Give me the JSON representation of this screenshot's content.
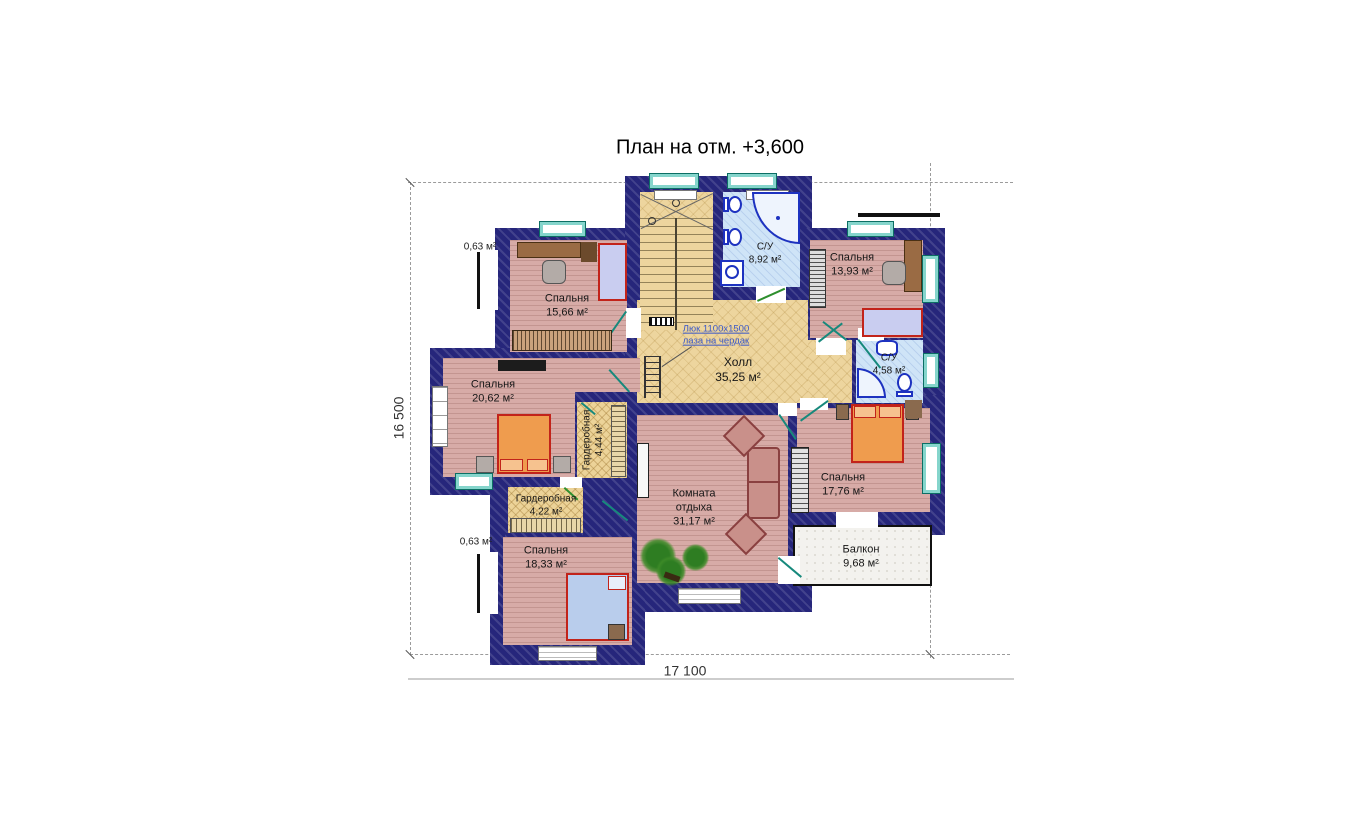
{
  "title": "План на отм. +3,600",
  "dimensions": {
    "vertical": "16 500",
    "horizontal": "17 100"
  },
  "annotations": {
    "attic_hatch_line1": "Люк 1100х1500",
    "attic_hatch_line2": "лаза на чердак",
    "niche_area_top": "0,63 м²",
    "niche_area_bottom": "0,63 м²"
  },
  "rooms": [
    {
      "id": "bedroom-top-left",
      "name": "Спальня",
      "area": "15,66 м²"
    },
    {
      "id": "bathroom-top",
      "name": "С/У",
      "area": "8,92 м²"
    },
    {
      "id": "bedroom-top-right",
      "name": "Спальня",
      "area": "13,93 м²"
    },
    {
      "id": "hall",
      "name": "Холл",
      "area": "35,25 м²"
    },
    {
      "id": "bedroom-left",
      "name": "Спальня",
      "area": "20,62 м²"
    },
    {
      "id": "wardrobe-middle",
      "name": "Гардеробная",
      "area": "4,44 м²"
    },
    {
      "id": "bathroom-right",
      "name": "С/У",
      "area": "4,58 м²"
    },
    {
      "id": "bedroom-right",
      "name": "Спальня",
      "area": "17,76 м²"
    },
    {
      "id": "lounge",
      "name_line1": "Комната",
      "name_line2": "отдыха",
      "area": "31,17 м²"
    },
    {
      "id": "wardrobe-bottom",
      "name": "Гардеробная",
      "area": "4,22 м²"
    },
    {
      "id": "bedroom-bottom-left",
      "name": "Спальня",
      "area": "18,33 м²"
    },
    {
      "id": "balcony",
      "name": "Балкон",
      "area": "9,68 м²"
    }
  ],
  "colors": {
    "wall": "#26267B",
    "bedroom_floor": "#D7ABA7",
    "hall_floor": "#EDD59E",
    "bathroom_floor": "#CFE4F7",
    "wardrobe_floor": "#ECD398",
    "balcony_floor": "#F3F2EE",
    "window_frame": "#85D5CC",
    "furniture_red_outline": "#C2231A",
    "bed_orange": "#EF9C4E",
    "fixture_blue": "#1D32C0",
    "note_blue": "#3A58C8"
  }
}
